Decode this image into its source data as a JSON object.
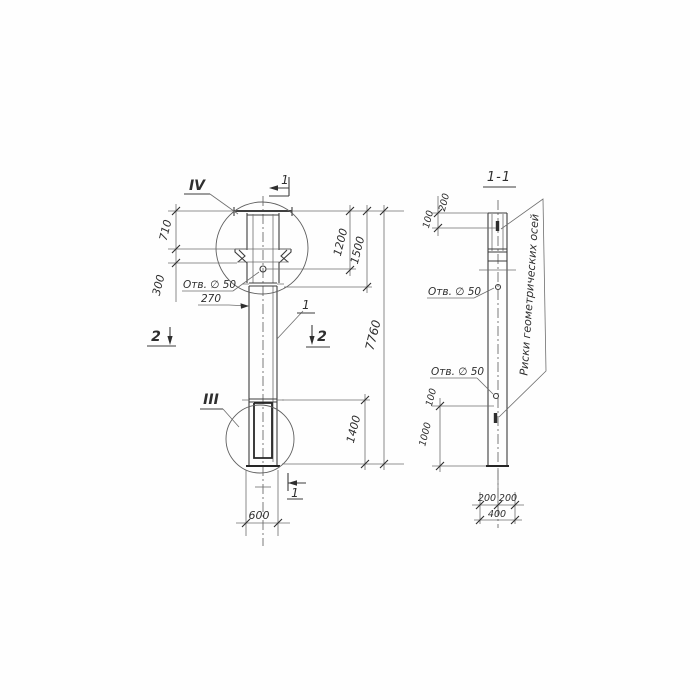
{
  "front": {
    "detail_top": "IV",
    "detail_bottom": "III",
    "pos_label": "1",
    "section1": "1",
    "section2": "2",
    "dim_710": "710",
    "dim_300": "300",
    "hole_label": "Отв. ∅ 50",
    "dim_270": "270",
    "dim_1200": "1200",
    "dim_1500": "1500",
    "dim_7760": "7760",
    "dim_1400": "1400",
    "dim_600": "600"
  },
  "side": {
    "title": "1-1",
    "hole_label_upper": "Отв. ∅ 50",
    "hole_label_lower": "Отв. ∅ 50",
    "axis_marks_label": "Риски геометрических осей",
    "dim_200_top": "200",
    "dim_100_top": "100",
    "dim_100_bottom": "100",
    "dim_1000": "1000",
    "dim_200_left": "200",
    "dim_200_right": "200",
    "dim_400": "400"
  }
}
